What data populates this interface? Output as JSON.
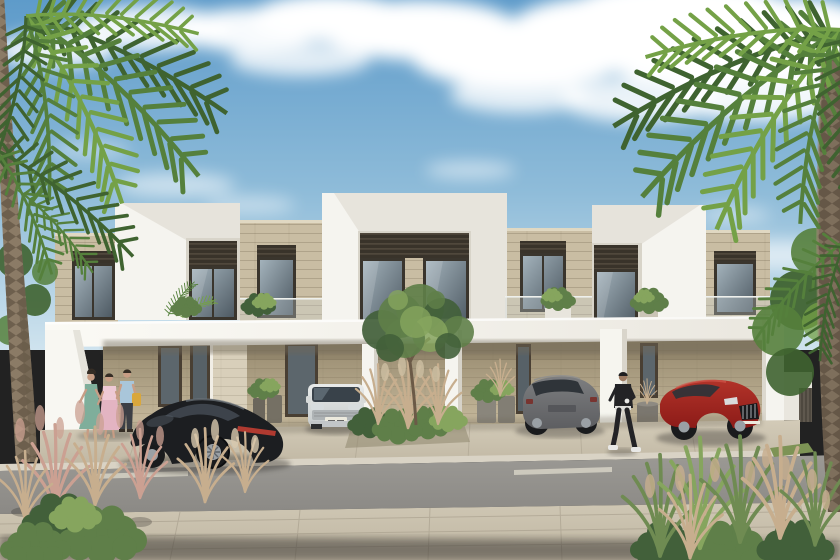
{
  "scene": {
    "title": "Modern townhouse community — exterior architectural rendering",
    "description": "Daytime architectural rendering of a row of modern two-storey townhouses with white parapet volumes, beige stone cladding and dark louvers. A long white carport canopy shelters four parked cars: a black sports coupe, a white compact SUV, a grey SUV and a red sports sedan. Three people talk near the left entrance and a person in black walks past on the right. Tall palm trees frame the left and right edges, ornamental grasses fill the foreground, and an asphalt street with a dashed lane line and large pavers runs across the bottom.",
    "setting": "daytime, clear blue sky with scattered white clouds",
    "objects": [
      {
        "name": "sky",
        "description": "blue sky with scattered soft clouds"
      },
      {
        "name": "left-palm-tree",
        "description": "tall palm, trunk along left edge, fronds over top-left corner"
      },
      {
        "name": "right-palm-tree",
        "description": "tall palm, thick trunk on right edge, fronds over top-right corner"
      },
      {
        "name": "townhouse-row",
        "description": "two-storey modern townhouses: three white frame parapet volumes with dark louver bands and glass, beige stone sections with dark framed windows, glass balcony balustrades with potted plants"
      },
      {
        "name": "carport-canopy",
        "description": "long white horizontal canopy over ground-floor carports with white piers"
      },
      {
        "name": "black-sports-coupe",
        "description": "dark sports coupe with full-width red tail light, parked angled at left"
      },
      {
        "name": "white-suv",
        "description": "white compact SUV parked facing out of carport"
      },
      {
        "name": "grey-suv",
        "description": "grey crossover SUV seen from rear, centre-right carport"
      },
      {
        "name": "red-sedan",
        "description": "red sports sedan with chrome grille, right carport"
      },
      {
        "name": "pedestrian-group",
        "description": "three adults talking: woman in teal dress, woman in pink dress, man in light blue shirt with yellow bag"
      },
      {
        "name": "pedestrian-black-outfit",
        "description": "person in black jacket and trousers with white sneakers walking right of centre"
      },
      {
        "name": "central-tree",
        "description": "small green tree in planting bed at the centre of the driveway"
      },
      {
        "name": "ornamental-grasses",
        "description": "pink pampas and green ornamental grasses in the foreground corners and centre bed"
      },
      {
        "name": "street",
        "description": "asphalt road with short dashed lane marking"
      },
      {
        "name": "sidewalk-pavers",
        "description": "large beige concrete pavers across the foreground with a dark shadow band at the bottom edge"
      }
    ]
  },
  "palette": {
    "skyTop": "#5e9bca",
    "skyMid": "#8fbcd9",
    "skyLow": "#cfe3ee",
    "cloud": "#ffffff",
    "wallWhite": "#f5f4ef",
    "wallWhiteShade": "#e4e1d8",
    "fasciaLight": "#fbfaf5",
    "fasciaDark": "#eae7df",
    "stoneLight": "#c9bda3",
    "stoneCap": "#e0d8c2",
    "carportTop": "#94876c",
    "carportBot": "#c9bc9f",
    "louverDark": "#39332a",
    "louverLight": "#6b6252",
    "frameDark": "#3a352d",
    "doorDark": "#493f33",
    "glassLight": "#a3b2bb",
    "glassDark": "#4e5a63",
    "plantGreen": "#5f7f49",
    "plantGreenDark": "#42603a",
    "plantGreenLight": "#86a55e",
    "palmGreen": "#55803c",
    "palmGreenDark": "#3f6330",
    "palmGreenLight": "#74a147",
    "trunkLeft": "#8b7b66",
    "trunkRight": "#7e6f5c",
    "grassTan": "#c7ae8e",
    "grassPink": "#cba092",
    "grassGreen": "#6f8b52",
    "road": "#8b8985",
    "roadLight": "#9b9994",
    "dash": "#d6d2c6",
    "apron": "#c1b8a4",
    "apronLight": "#d3cbb8",
    "paver": "#bfb6a2",
    "paverLight": "#cfc7b4",
    "paverLine": "#a59c8a",
    "shadow": "#34322d",
    "carBlack": "#1c1e21",
    "carBlackHi": "#70777f",
    "tailRed": "#b03a30",
    "suvWhiteHi": "#e9ebea",
    "suvWhiteLo": "#c6cbcc",
    "suvGrayHi": "#7d7e80",
    "suvGrayLo": "#5d5e61",
    "carRedHi": "#b23329",
    "carRedLo": "#8c1b18",
    "chrome": "#cfd3d6",
    "wheel": "#1a1b1d",
    "wheelRim": "#9aa0a5",
    "skin": "#c79d85",
    "hair": "#352d25",
    "dressTeal": "#7fae9b",
    "dressPink": "#e3b4c2",
    "shirtBlue": "#a9c6da",
    "bagYellow": "#d9a73c",
    "outfitBlack": "#232326",
    "shoeWhite": "#e8e8e6",
    "lawn": "#7d9355",
    "gate": "#5f584e"
  },
  "vehicles": [
    {
      "type": "black sports coupe",
      "position": "left carport bay, angled toward street"
    },
    {
      "type": "white compact SUV",
      "position": "second bay from left, facing street"
    },
    {
      "type": "grey crossover SUV",
      "position": "second bay from right, rear view"
    },
    {
      "type": "red sports sedan",
      "position": "right carport bay, front three-quarter view"
    }
  ],
  "people": [
    {
      "who": "three adults talking",
      "position": "left, in front of white entrance wall"
    },
    {
      "who": "person in black outfit walking",
      "position": "right of centre, in front of white pier"
    }
  ]
}
